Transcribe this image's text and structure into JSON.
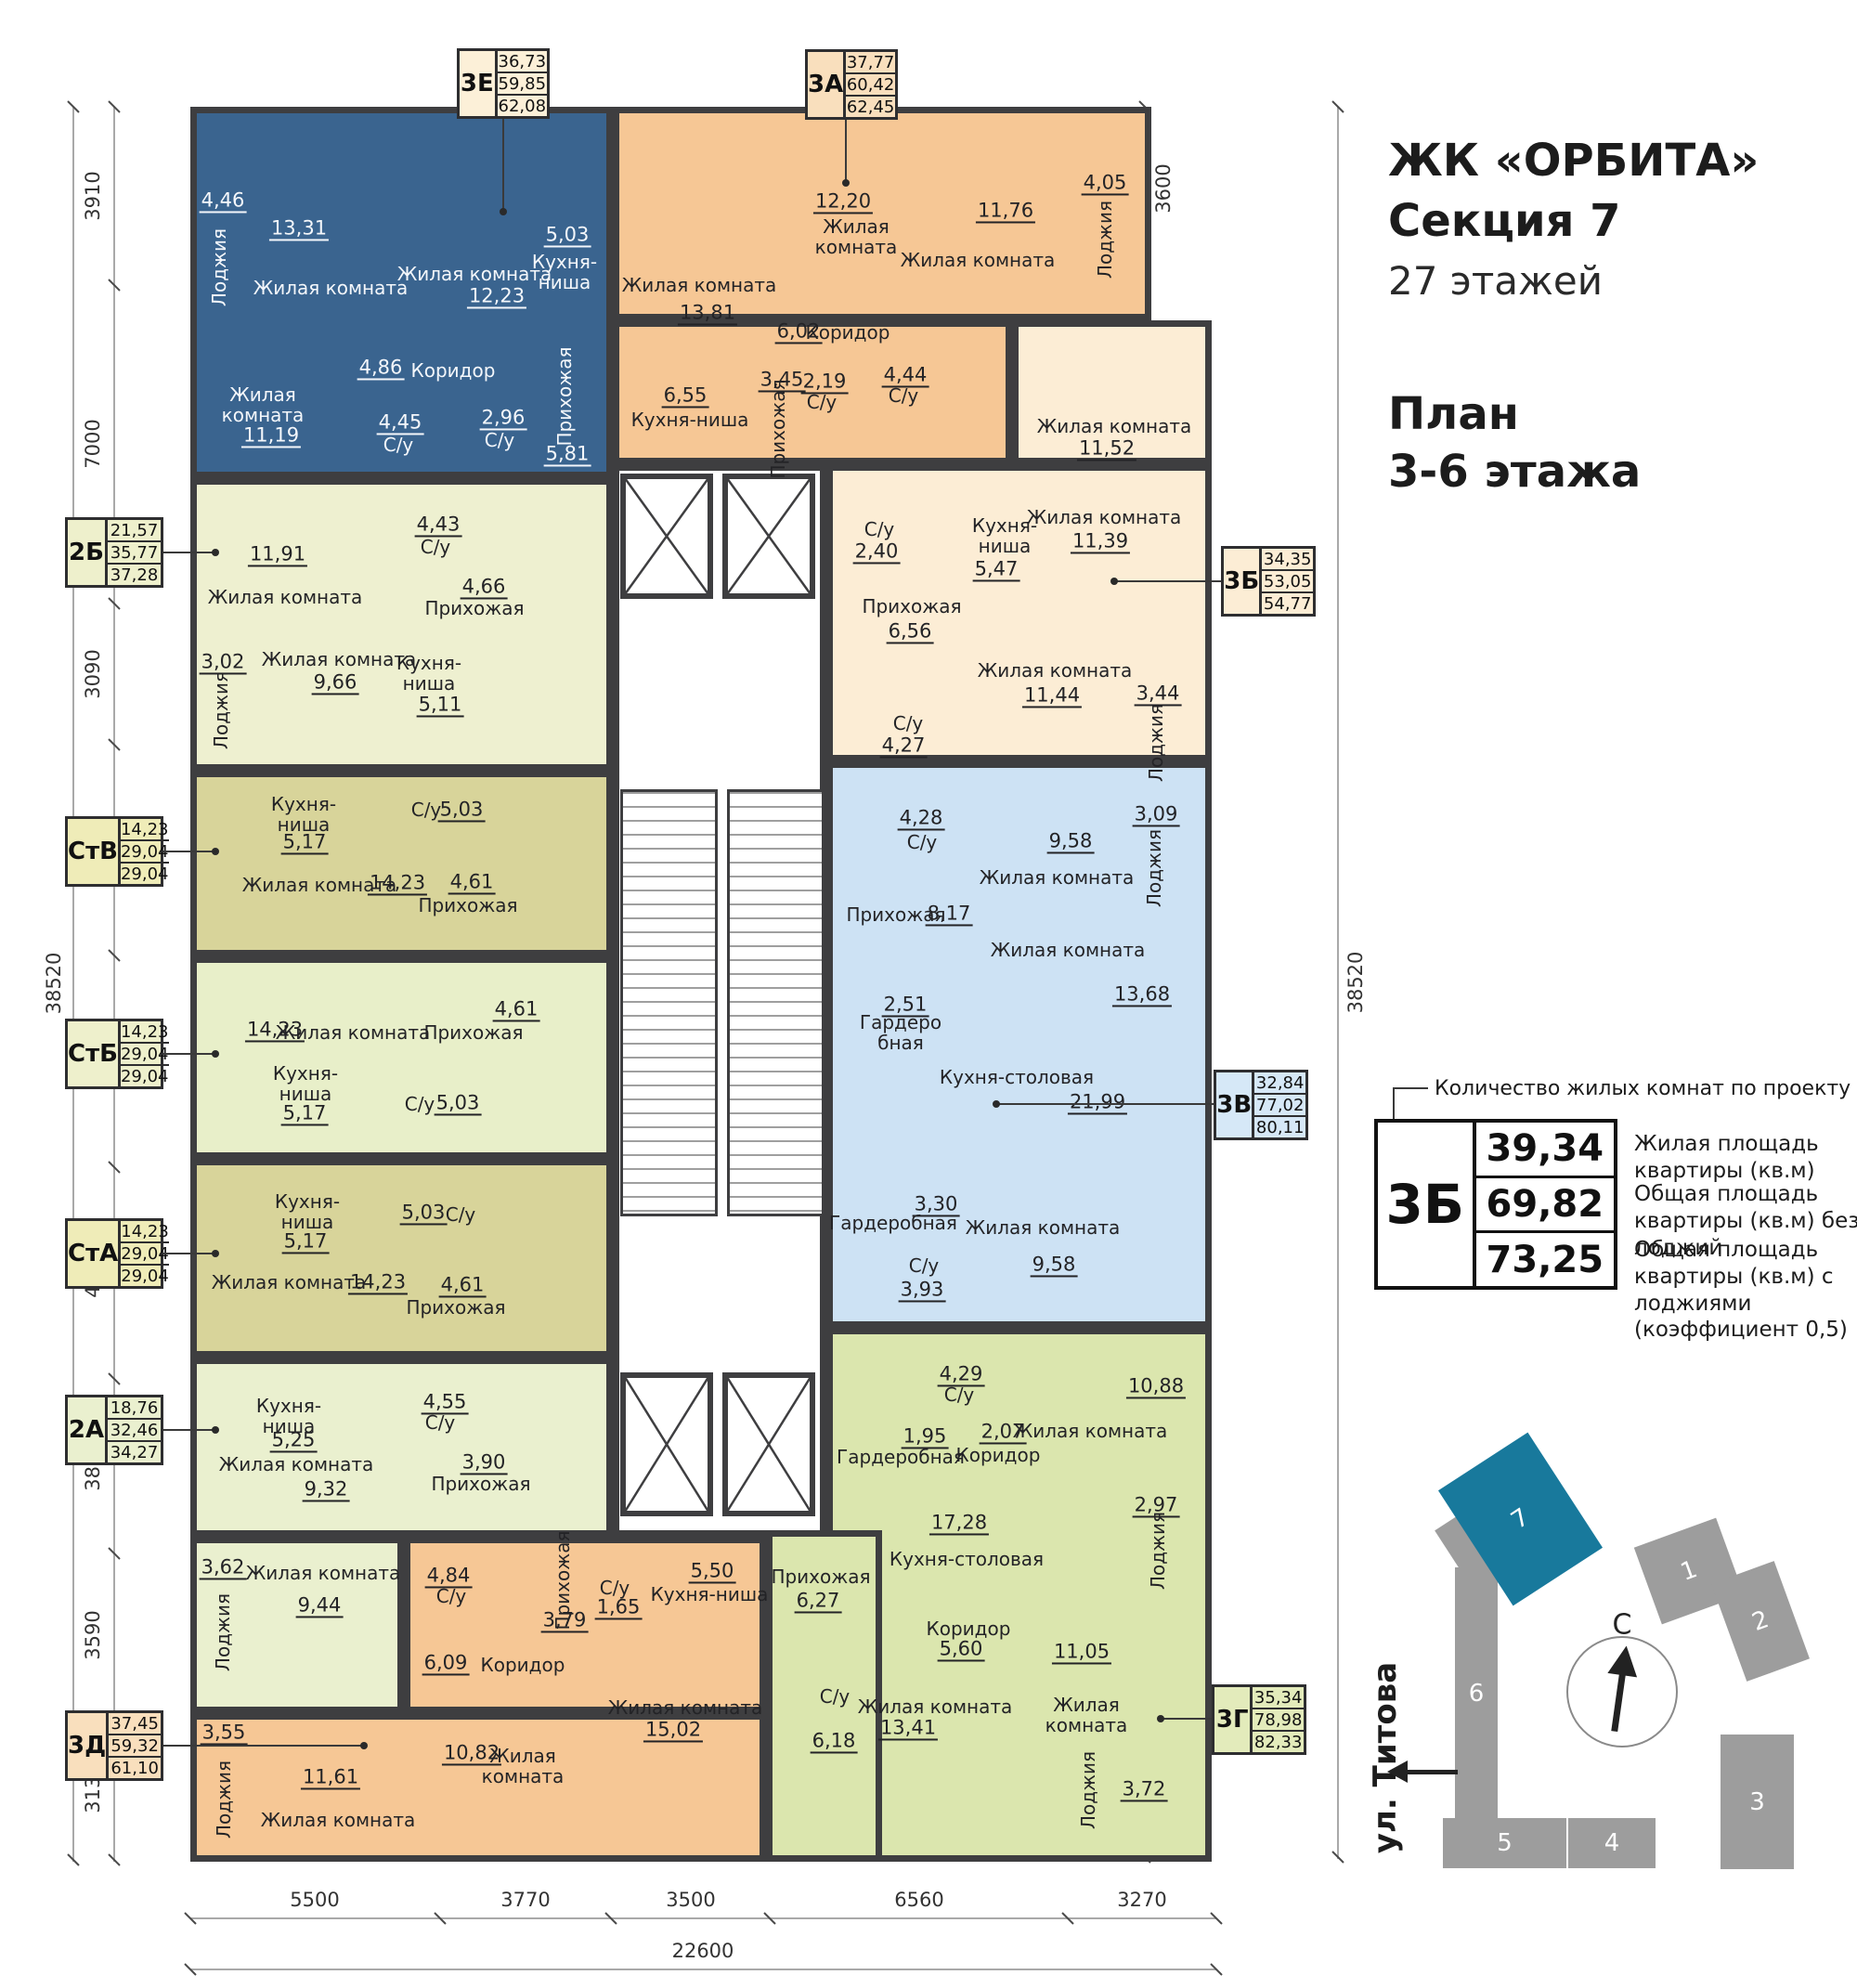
{
  "header": {
    "project": "ЖК «ОРБИТА»",
    "section": "Секция 7",
    "floors": "27 этажей",
    "plan_line1": "План",
    "plan_line2": "3-6 этажа"
  },
  "legend": {
    "callout": "Количество жилых комнат по проекту и буквенный код",
    "example_code": "3Б",
    "example_values": [
      "39,34",
      "69,82",
      "73,25"
    ],
    "value_labels": [
      "Жилая площадь квартиры (кв.м)",
      "Общая площадь квартиры (кв.м) без лоджий",
      "Общая площадь квартиры (кв.м) с лоджиями (коэффициент 0,5)"
    ]
  },
  "site_plan": {
    "street": "ул. Титова",
    "compass": "С",
    "highlighted": "7",
    "buildings": [
      "1",
      "2",
      "3",
      "4",
      "5",
      "6",
      "7"
    ]
  },
  "dimensions": {
    "left": [
      "3910",
      "7000",
      "3090",
      "4650",
      "4650",
      "4650",
      "3850",
      "3590",
      "3130"
    ],
    "left_total": "38520",
    "right": [
      "3600",
      "3590",
      "3650",
      "3490",
      "3190",
      "3250",
      "3250",
      "3190",
      "3250",
      "3090",
      "4970"
    ],
    "right_total": "38520",
    "bottom": [
      "5500",
      "3770",
      "3500",
      "6560",
      "3270"
    ],
    "bottom_total": "22600"
  },
  "colors": {
    "wall": "#3e3e40",
    "apt_3e": "#3a648f",
    "apt_3a": "#f6c795",
    "apt_3b": "#fcedd5",
    "apt_2b": "#eef0d0",
    "apt_stv": "#d8d49a",
    "apt_stb": "#e8efc9",
    "apt_sta": "#d8d49a",
    "apt_2a": "#eaf0cf",
    "apt_3d": "#f6c795",
    "apt_3v": "#cde2f4",
    "apt_3g": "#dbe6ae",
    "site_gray": "#9d9d9d",
    "site_highlight": "#18799c"
  },
  "apartments": [
    {
      "code": "3Е",
      "values": [
        "36,73",
        "59,85",
        "62,08"
      ],
      "color": "#3a648f",
      "rooms": [
        {
          "name": "Лоджия",
          "area": "4,46"
        },
        {
          "name": "Жилая комната",
          "area": "13,31"
        },
        {
          "name": "Жилая комната",
          "area": "12,23"
        },
        {
          "name": "Кухня-ниша",
          "area": "5,03"
        },
        {
          "name": "Коридор",
          "area": "4,86"
        },
        {
          "name": "Жилая комната",
          "area": "11,19"
        },
        {
          "name": "С/у",
          "area": "4,45"
        },
        {
          "name": "С/у",
          "area": "2,96"
        },
        {
          "name": "Прихожая",
          "area": "5,81"
        }
      ]
    },
    {
      "code": "3А",
      "values": [
        "37,77",
        "60,42",
        "62,45"
      ],
      "color": "#f6c795",
      "rooms": [
        {
          "name": "Жилая комната",
          "area": "12,20"
        },
        {
          "name": "Жилая комната",
          "area": "11,76"
        },
        {
          "name": "Лоджия",
          "area": "4,05"
        },
        {
          "name": "Жилая комната",
          "area": "13,81"
        },
        {
          "name": "Коридор",
          "area": "6,02"
        },
        {
          "name": "Кухня-ниша",
          "area": "6,55"
        },
        {
          "name": "Прихожая",
          "area": "3,45"
        },
        {
          "name": "С/у",
          "area": "2,19"
        },
        {
          "name": "С/у",
          "area": "4,44"
        }
      ]
    },
    {
      "code": "3Б",
      "values": [
        "34,35",
        "53,05",
        "54,77"
      ],
      "color": "#fcedd5",
      "rooms": [
        {
          "name": "Жилая комната",
          "area": "11,52"
        },
        {
          "name": "Кухня-ниша",
          "area": "5,47"
        },
        {
          "name": "Жилая комната",
          "area": "11,39"
        },
        {
          "name": "С/у",
          "area": "2,40"
        },
        {
          "name": "Прихожая",
          "area": "6,56"
        },
        {
          "name": "Жилая комната",
          "area": "11,44"
        },
        {
          "name": "С/у",
          "area": "4,27"
        },
        {
          "name": "Лоджия",
          "area": "3,44"
        }
      ]
    },
    {
      "code": "2Б",
      "values": [
        "21,57",
        "35,77",
        "37,28"
      ],
      "color": "#eef0d0",
      "rooms": [
        {
          "name": "Жилая комната",
          "area": "11,91"
        },
        {
          "name": "С/у",
          "area": "4,43"
        },
        {
          "name": "Прихожая",
          "area": "4,66"
        },
        {
          "name": "Жилая комната",
          "area": "9,66"
        },
        {
          "name": "Кухня-ниша",
          "area": "5,11"
        },
        {
          "name": "Лоджия",
          "area": "3,02"
        }
      ]
    },
    {
      "code": "СтВ",
      "values": [
        "14,23",
        "29,04",
        "29,04"
      ],
      "color": "#d8d49a",
      "rooms": [
        {
          "name": "Кухня-ниша",
          "area": "5,17"
        },
        {
          "name": "С/у",
          "area": "5,03"
        },
        {
          "name": "Жилая комната",
          "area": "14,23"
        },
        {
          "name": "Прихожая",
          "area": "4,61"
        }
      ]
    },
    {
      "code": "СтБ",
      "values": [
        "14,23",
        "29,04",
        "29,04"
      ],
      "color": "#e8efc9",
      "rooms": [
        {
          "name": "Жилая комната",
          "area": "14,23"
        },
        {
          "name": "Прихожая",
          "area": "4,61"
        },
        {
          "name": "Кухня-ниша",
          "area": "5,17"
        },
        {
          "name": "С/у",
          "area": "5,03"
        }
      ]
    },
    {
      "code": "СтА",
      "values": [
        "14,23",
        "29,04",
        "29,04"
      ],
      "color": "#d8d49a",
      "rooms": [
        {
          "name": "Кухня-ниша",
          "area": "5,17"
        },
        {
          "name": "С/у",
          "area": "5,03"
        },
        {
          "name": "Жилая комната",
          "area": "14,23"
        },
        {
          "name": "Прихожая",
          "area": "4,61"
        }
      ]
    },
    {
      "code": "2А",
      "values": [
        "18,76",
        "32,46",
        "34,27"
      ],
      "color": "#eaf0cf",
      "rooms": [
        {
          "name": "Кухня-ниша",
          "area": "5,25"
        },
        {
          "name": "С/у",
          "area": "4,55"
        },
        {
          "name": "Жилая комната",
          "area": "9,32"
        },
        {
          "name": "Прихожая",
          "area": "3,90"
        },
        {
          "name": "Жилая комната",
          "area": "9,44"
        },
        {
          "name": "Лоджия",
          "area": "3,62"
        }
      ]
    },
    {
      "code": "3Д",
      "values": [
        "37,45",
        "59,32",
        "61,10"
      ],
      "color": "#f6c795",
      "rooms": [
        {
          "name": "С/у",
          "area": "4,84"
        },
        {
          "name": "Коридор",
          "area": "6,09"
        },
        {
          "name": "Лоджия",
          "area": "3,55"
        },
        {
          "name": "Жилая комната",
          "area": "11,61"
        },
        {
          "name": "Жилая комната",
          "area": "10,82"
        },
        {
          "name": "Прихожая",
          "area": "3,79"
        },
        {
          "name": "С/у",
          "area": "1,65"
        },
        {
          "name": "Кухня-ниша",
          "area": "5,50"
        },
        {
          "name": "Жилая комната",
          "area": "15,02"
        }
      ]
    },
    {
      "code": "3В",
      "values": [
        "32,84",
        "77,02",
        "80,11"
      ],
      "color": "#cde2f4",
      "rooms": [
        {
          "name": "С/у",
          "area": "4,28"
        },
        {
          "name": "Жилая комната",
          "area": "9,58"
        },
        {
          "name": "Лоджия",
          "area": "3,09"
        },
        {
          "name": "Прихожая",
          "area": "8,17"
        },
        {
          "name": "Жилая комната",
          "area": "13,68"
        },
        {
          "name": "Гардеробная",
          "area": "2,51"
        },
        {
          "name": "Кухня-столовая",
          "area": "21,99"
        },
        {
          "name": "Гардеробная",
          "area": "3,30"
        },
        {
          "name": "Жилая комната",
          "area": "9,58"
        },
        {
          "name": "С/у",
          "area": "3,93"
        }
      ]
    },
    {
      "code": "3Г",
      "values": [
        "35,34",
        "78,98",
        "82,33"
      ],
      "color": "#dbe6ae",
      "rooms": [
        {
          "name": "С/у",
          "area": "4,29"
        },
        {
          "name": "Жилая комната",
          "area": "10,88"
        },
        {
          "name": "Гардеробная",
          "area": "1,95"
        },
        {
          "name": "Коридор",
          "area": "2,07"
        },
        {
          "name": "Кухня-столовая",
          "area": "17,28"
        },
        {
          "name": "Лоджия",
          "area": "2,97"
        },
        {
          "name": "Коридор",
          "area": "5,60"
        },
        {
          "name": "Прихожая",
          "area": "6,27"
        },
        {
          "name": "С/у",
          "area": "6,18"
        },
        {
          "name": "Жилая комната",
          "area": "13,41"
        },
        {
          "name": "Жилая комната",
          "area": "11,05"
        },
        {
          "name": "Лоджия",
          "area": "3,72"
        }
      ]
    }
  ]
}
